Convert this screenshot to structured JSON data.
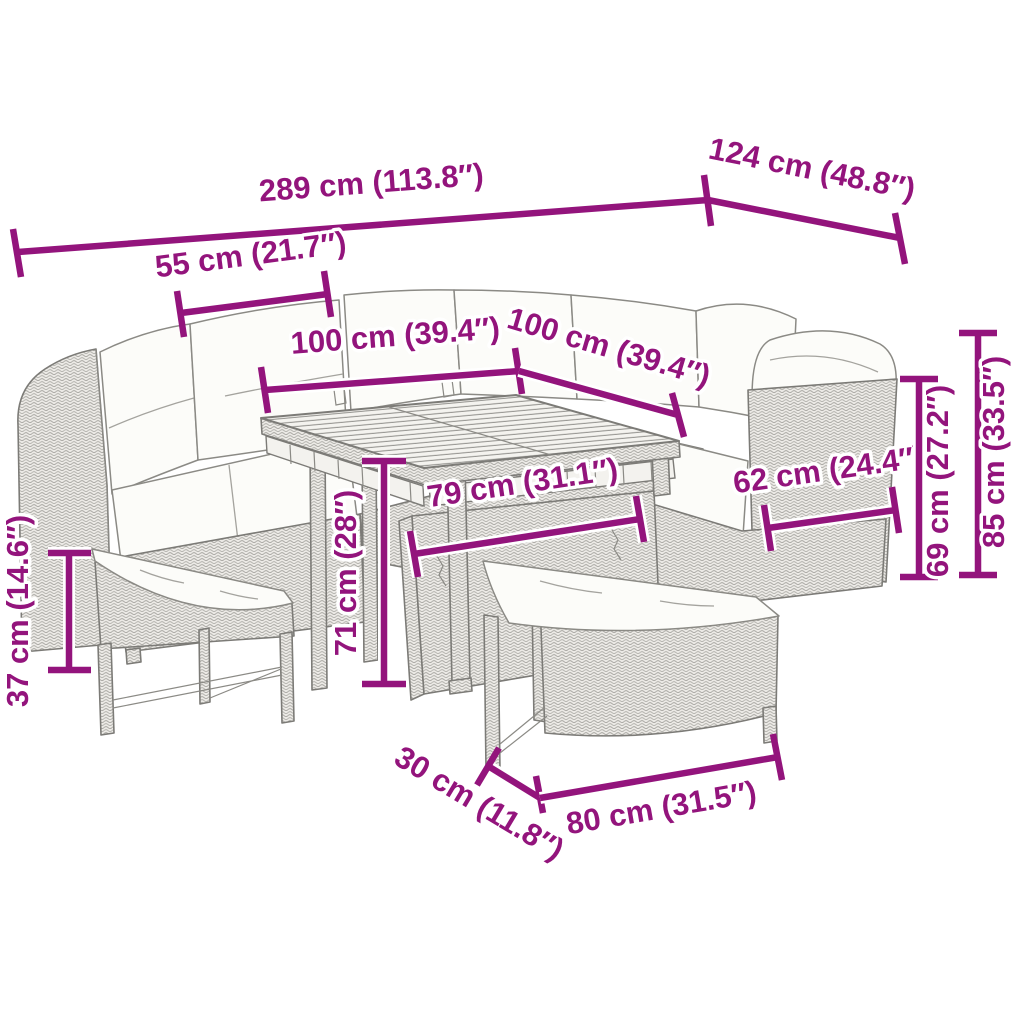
{
  "diagram": {
    "type": "product-dimension-diagram",
    "accent_color": "#93147C",
    "line_art_color": "#7c7b77",
    "background_color": "#ffffff",
    "objects": [
      "corner-sofa-left-section",
      "corner-sofa-back-section",
      "corner-sofa-right-section",
      "storage-table",
      "bench-left",
      "bench-front"
    ],
    "dimensions": {
      "total_length": "289 cm (113.8″)",
      "total_depth": "124 cm (48.8″)",
      "seat_section_width": "55 cm (21.7″)",
      "table_length": "100 cm (39.4″)",
      "table_depth": "100 cm (39.4″)",
      "armrest_depth": "62 cm (24.4″)",
      "seat_back_height": "69 cm (27.2″)",
      "total_height": "85 cm (33.5″)",
      "table_inner_length": "79 cm (31.1″)",
      "table_height": "71 cm (28″)",
      "bench_height": "37 cm (14.6″)",
      "bench_depth": "30 cm (11.8″)",
      "bench_length": "80 cm (31.5″)"
    }
  }
}
